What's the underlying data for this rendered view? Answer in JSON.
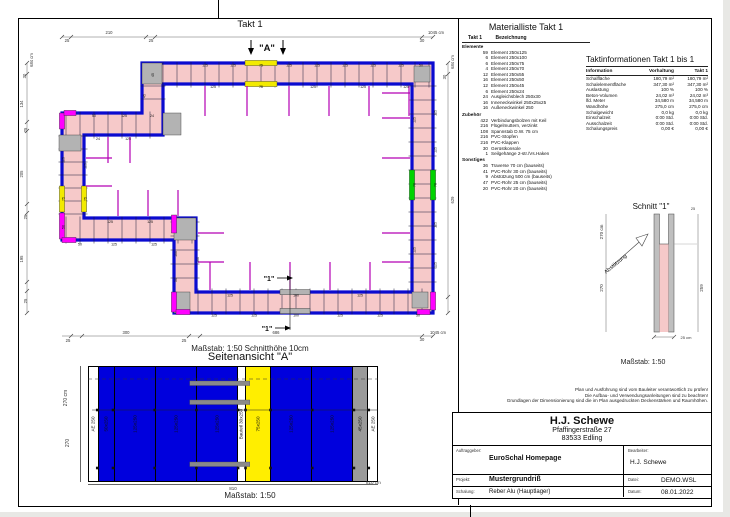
{
  "page": {
    "takt_header": "Takt 1",
    "plan_scale_note": "Maßstab: 1:50   Schnitthöhe 10cm"
  },
  "plan": {
    "marker_a": "\"A\"",
    "section_marker": "\"1\"",
    "labels": [
      {
        "t": "25",
        "x": 49,
        "y": 24,
        "s": 4.2,
        "c": "#333"
      },
      {
        "t": "210",
        "x": 91,
        "y": 16,
        "s": 4.2,
        "c": "#333"
      },
      {
        "t": "25",
        "x": 133,
        "y": 24,
        "s": 4.2,
        "c": "#333"
      },
      {
        "t": "30",
        "x": 404,
        "y": 24,
        "s": 4.2,
        "c": "#333"
      },
      {
        "t": "1045 cm",
        "x": 418,
        "y": 16,
        "s": 4.2,
        "c": "#333"
      },
      {
        "t": "684 cm",
        "x": 15,
        "y": 42,
        "r": 1,
        "s": 4.2,
        "c": "#333"
      },
      {
        "t": "30",
        "x": 8,
        "y": 58,
        "r": 1,
        "s": 4.2,
        "c": "#333"
      },
      {
        "t": "134",
        "x": 5,
        "y": 86,
        "r": 1,
        "s": 4.2,
        "c": "#333"
      },
      {
        "t": "25",
        "x": 9,
        "y": 112,
        "r": 1,
        "s": 4.2,
        "c": "#333"
      },
      {
        "t": "205",
        "x": 5,
        "y": 156,
        "r": 1,
        "s": 4.2,
        "c": "#333"
      },
      {
        "t": "25",
        "x": 9,
        "y": 199,
        "r": 1,
        "s": 4.2,
        "c": "#333"
      },
      {
        "t": "195",
        "x": 5,
        "y": 241,
        "r": 1,
        "s": 4.2,
        "c": "#333"
      },
      {
        "t": "25",
        "x": 9,
        "y": 283,
        "r": 1,
        "s": 4.2,
        "c": "#333"
      },
      {
        "t": "684 cm",
        "x": 436,
        "y": 44,
        "r": 1,
        "s": 4.2,
        "c": "#333"
      },
      {
        "t": "30",
        "x": 428,
        "y": 59,
        "r": 1,
        "s": 4.2,
        "c": "#333"
      },
      {
        "t": "629",
        "x": 436,
        "y": 182,
        "r": 1,
        "s": 4.2,
        "c": "#333"
      },
      {
        "t": "25",
        "x": 50,
        "y": 324,
        "s": 4.2,
        "c": "#333"
      },
      {
        "t": "300",
        "x": 108,
        "y": 316,
        "s": 4.2,
        "c": "#333"
      },
      {
        "t": "25",
        "x": 166,
        "y": 324,
        "s": 4.2,
        "c": "#333"
      },
      {
        "t": "686",
        "x": 258,
        "y": 316,
        "s": 4.2,
        "c": "#333"
      },
      {
        "t": "30",
        "x": 404,
        "y": 323,
        "s": 4.2,
        "c": "#333"
      },
      {
        "t": "1045 cm",
        "x": 420,
        "y": 316,
        "s": 4.2,
        "c": "#333"
      },
      {
        "t": "125",
        "x": 187,
        "y": 48.4
      },
      {
        "t": "125",
        "x": 215,
        "y": 48.4
      },
      {
        "t": "75",
        "x": 243,
        "y": 48.4
      },
      {
        "t": "125",
        "x": 271,
        "y": 48.4
      },
      {
        "t": "125",
        "x": 299,
        "y": 48.4
      },
      {
        "t": "125",
        "x": 327,
        "y": 48.4
      },
      {
        "t": "125",
        "x": 355,
        "y": 48.4
      },
      {
        "t": "125",
        "x": 383,
        "y": 48.4
      },
      {
        "t": "50",
        "x": 403,
        "y": 48.4
      },
      {
        "t": "125",
        "x": 195,
        "y": 69.9
      },
      {
        "t": "75",
        "x": 243,
        "y": 69.9
      },
      {
        "t": "125",
        "x": 295,
        "y": 69.9
      },
      {
        "t": "125",
        "x": 345,
        "y": 69.9
      },
      {
        "t": "125",
        "x": 388,
        "y": 69.9
      },
      {
        "t": "125",
        "x": 418.4,
        "y": 95,
        "r": 1
      },
      {
        "t": "125",
        "x": 418.4,
        "y": 132,
        "r": 1
      },
      {
        "t": "70",
        "x": 418.4,
        "y": 167,
        "r": 1
      },
      {
        "t": "125",
        "x": 418.4,
        "y": 207,
        "r": 1
      },
      {
        "t": "125",
        "x": 418.4,
        "y": 247,
        "r": 1
      },
      {
        "t": "125",
        "x": 397.4,
        "y": 102,
        "r": 1
      },
      {
        "t": "70",
        "x": 397.4,
        "y": 167,
        "r": 1
      },
      {
        "t": "125",
        "x": 397.4,
        "y": 232,
        "r": 1
      },
      {
        "t": "125",
        "x": 196,
        "y": 298.4
      },
      {
        "t": "125",
        "x": 236,
        "y": 298.4
      },
      {
        "t": "100",
        "x": 278,
        "y": 298.4
      },
      {
        "t": "125",
        "x": 322,
        "y": 298.4
      },
      {
        "t": "125",
        "x": 362,
        "y": 298.4
      },
      {
        "t": "50",
        "x": 400,
        "y": 298.4
      },
      {
        "t": "125",
        "x": 212,
        "y": 278.4
      },
      {
        "t": "100",
        "x": 278,
        "y": 278.4
      },
      {
        "t": "125",
        "x": 342,
        "y": 278.4
      },
      {
        "t": "125",
        "x": 46.4,
        "y": 142,
        "r": 1
      },
      {
        "t": "75",
        "x": 46.4,
        "y": 181,
        "r": 1
      },
      {
        "t": "50",
        "x": 46.4,
        "y": 209,
        "r": 1
      },
      {
        "t": "125",
        "x": 68.4,
        "y": 148,
        "r": 1
      },
      {
        "t": "75",
        "x": 68.4,
        "y": 181,
        "r": 1
      },
      {
        "t": "100",
        "x": 158.8,
        "y": 236,
        "r": 1
      },
      {
        "t": "50",
        "x": 158.8,
        "y": 262,
        "r": 1
      },
      {
        "t": "100",
        "x": 180.8,
        "y": 242,
        "r": 1
      },
      {
        "t": "50",
        "x": 62,
        "y": 227.4
      },
      {
        "t": "125",
        "x": 96,
        "y": 227.4
      },
      {
        "t": "125",
        "x": 136,
        "y": 227.4
      },
      {
        "t": "125",
        "x": 92,
        "y": 204.9
      },
      {
        "t": "125",
        "x": 132,
        "y": 204.9
      },
      {
        "t": "50",
        "x": 76,
        "y": 98.9
      },
      {
        "t": "125",
        "x": 106,
        "y": 98.9
      },
      {
        "t": "24",
        "x": 134,
        "y": 98.9
      },
      {
        "t": "24",
        "x": 80,
        "y": 121.9
      },
      {
        "t": "125",
        "x": 110,
        "y": 121.9
      },
      {
        "t": "45",
        "x": 127.4,
        "y": 78,
        "r": 1
      },
      {
        "t": "45",
        "x": 136,
        "y": 57,
        "r": 1
      }
    ]
  },
  "materialliste": {
    "title": "Materialliste  Takt 1",
    "col1": "Takt 1",
    "col2": "Bezeichnung",
    "sections": [
      {
        "name": "Elemente",
        "items": [
          [
            "59",
            "Element 250x125"
          ],
          [
            "6",
            "Element 250x100"
          ],
          [
            "6",
            "Element 250x75"
          ],
          [
            "4",
            "Element 250x70"
          ],
          [
            "12",
            "Element 250x55"
          ],
          [
            "16",
            "Element 250x50"
          ],
          [
            "12",
            "Element 250x45"
          ],
          [
            "6",
            "Element 250x24"
          ],
          [
            "24",
            "Ausgleichsblech 250x30"
          ],
          [
            "16",
            "Inneneckwinkel 250x25x25"
          ],
          [
            "16",
            "Außeneckwinkel 250"
          ]
        ]
      },
      {
        "name": "Zubehör",
        "items": [
          [
            "422",
            "Verbindungsbolzen mit Keil"
          ],
          [
            "216",
            "Flügelmuttern, verzinkt"
          ],
          [
            "108",
            "Spannstab D.W. 75 cm"
          ],
          [
            "216",
            "PVC-Stopfen"
          ],
          [
            "216",
            "PVC-Klappen"
          ],
          [
            "30",
            "Gerüstkonsole"
          ],
          [
            "1",
            "Seilgehänge 2-str./Vs.Haken"
          ]
        ]
      },
      {
        "name": "Sonstiges",
        "items": [
          [
            "36",
            "Traverse 70 cm (bauseits)"
          ],
          [
            "41",
            "PVC-Rohr 30 cm (bauseits)"
          ],
          [
            "9",
            "Abstützung 500 cm (bauseits)"
          ],
          [
            "47",
            "PVC-Rohr 25 cm (bauseits)"
          ],
          [
            "20",
            "PVC-Rohr 20 cm (bauseits)"
          ]
        ]
      }
    ]
  },
  "taktinfo": {
    "title": "Taktinformationen  Takt 1 bis 1",
    "headers": [
      "Information",
      "Vorhaltung",
      "Takt 1"
    ],
    "rows": [
      [
        "Schalfläche",
        "180,79 m²",
        "180,79 m²"
      ],
      [
        "Schalelementfläche",
        "347,30 m²",
        "347,30 m²"
      ],
      [
        "Auslastung",
        "100 %",
        "100 %"
      ],
      [
        "Beton-Volumen",
        "24,02 m³",
        "24,02 m³"
      ],
      [
        "lfd. Meter",
        "34,580 m",
        "34,580 m"
      ],
      [
        "Wandhöhe",
        "275,0 cm",
        "275,0 cm"
      ],
      [
        "Schalgewicht",
        "0,0 kg",
        "0,0 kg"
      ],
      [
        "Einschalzeit",
        "0:00 Std.",
        "0:00 Std."
      ],
      [
        "Ausschalzeit",
        "0:00 Std.",
        "0:00 Std."
      ],
      [
        "Schalungspreis",
        "0,00 €",
        "0,00 €"
      ]
    ]
  },
  "schnitt": {
    "title": "Schnitt \"1\"",
    "brace_label": "Abstützung",
    "dim_height_upper": "270 cm",
    "dim_height_lower": "270",
    "dim_right_top": "25",
    "dim_right": "259",
    "dim_bottom": "25 cm",
    "scale": "Maßstab: 1:50"
  },
  "seitenansicht": {
    "title": "Seitenansicht \"A\"",
    "panels": [
      {
        "label": "AE 250",
        "w": 10,
        "bg": "#ffffff"
      },
      {
        "label": "50x250",
        "w": 17,
        "bg": "#0000dd"
      },
      {
        "label": "125x250",
        "w": 45,
        "bg": "#0000dd"
      },
      {
        "label": "125x250",
        "w": 45,
        "bg": "#0000dd"
      },
      {
        "label": "125x250",
        "w": 45,
        "bg": "#0000dd"
      },
      {
        "label": "Bauteil 30x250",
        "w": 8,
        "bg": "#ffffff"
      },
      {
        "label": "75x250",
        "w": 27,
        "bg": "#ffee00"
      },
      {
        "label": "125x250",
        "w": 45,
        "bg": "#0000dd"
      },
      {
        "label": "125x250",
        "w": 45,
        "bg": "#0000dd"
      },
      {
        "label": "45x250",
        "w": 16,
        "bg": "#9a9a9a"
      },
      {
        "label": "AE 250",
        "w": 10,
        "bg": "#ffffff"
      }
    ],
    "dim_left_upper": "270 cm",
    "dim_left_lower": "270",
    "dim_bottom": "810",
    "dim_bottom_right": "810 cm",
    "scale": "Maßstab: 1:50"
  },
  "disclaimer": [
    "Plan und Ausführung sind vom Bauleiter verantwortlich zu prüfen!",
    "Die Aufbau- und Verwendungsanleitungen sind zu beachten!",
    "Grundlagen der Dimensionierung sind die im Plan ausgedruckten Deckenstärken und Raumhöhen."
  ],
  "titleblock": {
    "company": "H.J. Schewe",
    "address1": "Pfaffingerstraße 27",
    "address2": "83533 Edling",
    "fields": [
      {
        "label": "Auftraggeber:",
        "value": "EuroSchal Homepage"
      },
      {
        "label": "Bearbeiter:",
        "value": "H.J. Schewe"
      },
      {
        "label": "Projekt:",
        "value": "Mustergrundriß"
      },
      {
        "label": "Datei:",
        "value": "DEMO.WSL"
      },
      {
        "label": "Schalung:",
        "value": "Reber Alu (Hauptlager)"
      },
      {
        "label": "Datum:",
        "value": "08.01.2022"
      }
    ]
  },
  "colors": {
    "wall_fill": "#f6c9c9",
    "rail_blue": "#0b0bd0",
    "element_yellow": "#f2ea00",
    "element_green": "#00d300",
    "accent_magenta": "#ff00ff",
    "tie_magenta": "#b400b4",
    "panel_blue": "#0000dd",
    "panel_yellow": "#ffee00",
    "panel_gray": "#9a9a9a"
  }
}
